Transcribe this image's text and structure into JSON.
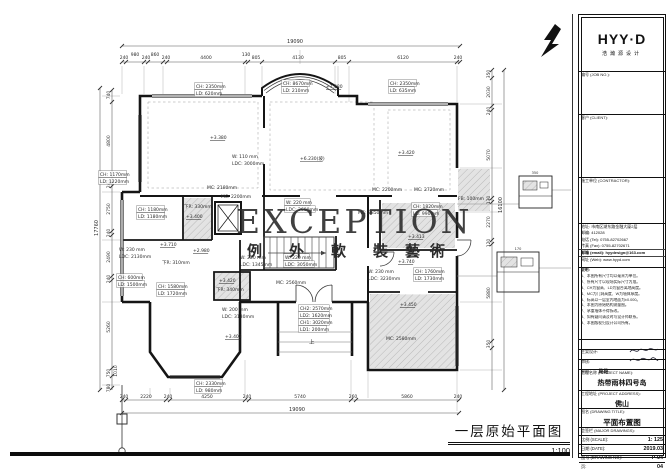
{
  "watermark": {
    "en": "EXCEPTION",
    "cn": [
      "例",
      "外",
      "軟",
      "裝",
      "藝",
      "術"
    ]
  },
  "footer": {
    "title": "一层原始平面图",
    "scale": "1:100"
  },
  "title_block": {
    "logo": "HYY·D",
    "logo_sub": "浩瀚源设计",
    "job_label": "编号 (JOB NO.):",
    "client_label": "客户 (CLIENT):",
    "contractor_label": "施工单位 (CONTRACTOR):",
    "contact": [
      "地址: 市南区湖东路金融大厦2层",
      "邮编: 412028",
      "电话 (Tel): 0755-82702667",
      "传真 (Fax): 0755-82702671",
      "邮箱 (email): hyydesign@163.com",
      "网址 (Web): www.hyyd.com"
    ],
    "notes_title": "说明:",
    "notes": [
      "1、本图所有尺寸均以毫米为单位。",
      "2、所有尺寸以现场实际尺寸为准。",
      "3、CH为窗高、LD为窗台离地高度。",
      "4、MC为门洞高度、W为墙体厚度。",
      "5、标高以一层室内地面为±0.000。",
      "6、本图为原始结构测量图。",
      "7、承重墙体不得拆改。",
      "8、如有疑问请及时与设计师联系。",
      "9、本图版权归设计公司所有。"
    ],
    "sign1_label": "主案设计:",
    "sign2_label": "审核:",
    "sign3_label": "制图:",
    "sign3_value": "路路",
    "project_name_label": "工程名称 (PROJECT NAME):",
    "project_name": "热带雨林四号岛",
    "project_addr_label": "工程地址 (PROJECT ADDRESS):",
    "project_addr": "佛山",
    "drawing_title_label": "图名 (DRAWING TITLE):",
    "drawing_title": "平面布置图",
    "countersign_label": "会签栏 (MAJOR DRAWINGS):",
    "scale_label": "比例 (SCALE):",
    "scale": "1: 125",
    "date_label": "日期 (DATE):",
    "date": "2019.03",
    "no_label": "图号 (DRAWING NO):",
    "no": "P-04",
    "page_label": "页:",
    "page": "04"
  },
  "plan_labels": [
    {
      "t": "19090",
      "x": 295,
      "y": 43,
      "s": 5,
      "a": "m"
    },
    {
      "t": "240",
      "x": 124,
      "y": 59,
      "a": "m"
    },
    {
      "t": "980",
      "x": 135,
      "y": 56,
      "a": "m"
    },
    {
      "t": "240",
      "x": 146,
      "y": 59,
      "a": "m"
    },
    {
      "t": "860",
      "x": 155,
      "y": 56,
      "a": "m"
    },
    {
      "t": "240",
      "x": 166,
      "y": 59,
      "a": "m"
    },
    {
      "t": "4400",
      "x": 206,
      "y": 59,
      "a": "m"
    },
    {
      "t": "130",
      "x": 246,
      "y": 56,
      "a": "m"
    },
    {
      "t": "805",
      "x": 256,
      "y": 59,
      "a": "m"
    },
    {
      "t": "4130",
      "x": 298,
      "y": 59,
      "a": "m"
    },
    {
      "t": "805",
      "x": 342,
      "y": 59,
      "a": "m"
    },
    {
      "t": "6120",
      "x": 403,
      "y": 59,
      "a": "m"
    },
    {
      "t": "240",
      "x": 458,
      "y": 59,
      "a": "m"
    },
    {
      "t": "240",
      "x": 124,
      "y": 398,
      "a": "m"
    },
    {
      "t": "2220",
      "x": 146,
      "y": 398,
      "a": "m"
    },
    {
      "t": "240",
      "x": 168,
      "y": 398,
      "a": "m"
    },
    {
      "t": "4250",
      "x": 207,
      "y": 398,
      "a": "m"
    },
    {
      "t": "240",
      "x": 247,
      "y": 398,
      "a": "m"
    },
    {
      "t": "5740",
      "x": 300,
      "y": 398,
      "a": "m"
    },
    {
      "t": "260",
      "x": 353,
      "y": 398,
      "a": "m"
    },
    {
      "t": "5860",
      "x": 407,
      "y": 398,
      "a": "m"
    },
    {
      "t": "240",
      "x": 458,
      "y": 398,
      "a": "m"
    },
    {
      "t": "19090",
      "x": 297,
      "y": 411,
      "s": 5,
      "a": "m"
    },
    {
      "t": "740",
      "x": 110,
      "y": 95,
      "r": -90,
      "a": "m"
    },
    {
      "t": "4800",
      "x": 110,
      "y": 141,
      "r": -90,
      "a": "m"
    },
    {
      "t": "240",
      "x": 110,
      "y": 184,
      "r": -90,
      "a": "m"
    },
    {
      "t": "2750",
      "x": 110,
      "y": 209,
      "r": -90,
      "a": "m"
    },
    {
      "t": "240",
      "x": 110,
      "y": 233,
      "r": -90,
      "a": "m"
    },
    {
      "t": "2490",
      "x": 110,
      "y": 257,
      "r": -90,
      "a": "m"
    },
    {
      "t": "240",
      "x": 110,
      "y": 279,
      "r": -90,
      "a": "m"
    },
    {
      "t": "5260",
      "x": 110,
      "y": 327,
      "r": -90,
      "a": "m"
    },
    {
      "t": "750",
      "x": 110,
      "y": 373,
      "r": -90,
      "a": "m"
    },
    {
      "t": "1010",
      "x": 117,
      "y": 371,
      "r": -90,
      "a": "m"
    },
    {
      "t": "780",
      "x": 110,
      "y": 388,
      "r": -90,
      "a": "m"
    },
    {
      "t": "17760",
      "x": 98,
      "y": 228,
      "r": -90,
      "s": 5,
      "a": "m"
    },
    {
      "t": "350",
      "x": 490,
      "y": 74,
      "r": -90,
      "a": "m"
    },
    {
      "t": "2030",
      "x": 490,
      "y": 92,
      "r": -90,
      "a": "m"
    },
    {
      "t": "240",
      "x": 490,
      "y": 111,
      "r": -90,
      "a": "m"
    },
    {
      "t": "5070",
      "x": 490,
      "y": 155,
      "r": -90,
      "a": "m"
    },
    {
      "t": "130",
      "x": 490,
      "y": 200,
      "r": -90,
      "a": "m"
    },
    {
      "t": "2270",
      "x": 490,
      "y": 222,
      "r": -90,
      "a": "m"
    },
    {
      "t": "120",
      "x": 490,
      "y": 243,
      "r": -90,
      "a": "m"
    },
    {
      "t": "5880",
      "x": 490,
      "y": 293,
      "r": -90,
      "a": "m"
    },
    {
      "t": "350",
      "x": 490,
      "y": 344,
      "r": -90,
      "a": "m"
    },
    {
      "t": "16100",
      "x": 502,
      "y": 205,
      "r": -90,
      "s": 5,
      "a": "m"
    },
    {
      "t": "CH: 2350mm",
      "x": 196,
      "y": 88,
      "b": 1
    },
    {
      "t": "LD: 620mm",
      "x": 196,
      "y": 95,
      "b": 1
    },
    {
      "t": "CH: 8670mm",
      "x": 283,
      "y": 85,
      "b": 1
    },
    {
      "t": "LD: 210mm",
      "x": 283,
      "y": 92,
      "b": 1
    },
    {
      "t": "+7.380",
      "x": 326,
      "y": 88,
      "u": 1
    },
    {
      "t": "CH: 2350mm",
      "x": 390,
      "y": 85,
      "b": 1
    },
    {
      "t": "LD: 635mm",
      "x": 390,
      "y": 92,
      "b": 1
    },
    {
      "t": "CH: 1170mm",
      "x": 100,
      "y": 176,
      "b": 1
    },
    {
      "t": "LD: 1220mm",
      "x": 100,
      "y": 183,
      "b": 1
    },
    {
      "t": "+3.380",
      "x": 210,
      "y": 139,
      "u": 1
    },
    {
      "t": "W: 110 mm",
      "x": 232,
      "y": 158
    },
    {
      "t": "LDC: 3000mm",
      "x": 232,
      "y": 165
    },
    {
      "t": "+6.230(坡)",
      "x": 300,
      "y": 160,
      "u": 1
    },
    {
      "t": "+3.420",
      "x": 398,
      "y": 154,
      "u": 1
    },
    {
      "t": "MC: 2180mm",
      "x": 207,
      "y": 189
    },
    {
      "t": "MC: 2200mm",
      "x": 221,
      "y": 198
    },
    {
      "t": "MC: 2200mm",
      "x": 372,
      "y": 191
    },
    {
      "t": "MC: 2720mm",
      "x": 414,
      "y": 191
    },
    {
      "t": "FB: 100mm",
      "x": 458,
      "y": 200
    },
    {
      "t": "CH: 1180mm",
      "x": 138,
      "y": 211,
      "b": 1
    },
    {
      "t": "LD: 1180mm",
      "x": 138,
      "y": 218,
      "b": 1
    },
    {
      "t": "下R: 330mm",
      "x": 184,
      "y": 208
    },
    {
      "t": "+3.400",
      "x": 186,
      "y": 218,
      "u": 1
    },
    {
      "t": "+3.710",
      "x": 160,
      "y": 246,
      "u": 1
    },
    {
      "t": "下R: 310mm",
      "x": 162,
      "y": 264
    },
    {
      "t": "+2.980",
      "x": 193,
      "y": 252,
      "u": 1
    },
    {
      "t": "W: 230 mm",
      "x": 119,
      "y": 251
    },
    {
      "t": "LDC: 2130mm",
      "x": 119,
      "y": 258
    },
    {
      "t": "CH: 600mm",
      "x": 118,
      "y": 279,
      "b": 1
    },
    {
      "t": "LD: 1500mm",
      "x": 118,
      "y": 286,
      "b": 1
    },
    {
      "t": "CH: 1580mm",
      "x": 158,
      "y": 288,
      "b": 1
    },
    {
      "t": "LD: 1720mm",
      "x": 158,
      "y": 295,
      "b": 1
    },
    {
      "t": "+3.420",
      "x": 219,
      "y": 282,
      "u": 1
    },
    {
      "t": "下R: 340mm",
      "x": 216,
      "y": 291
    },
    {
      "t": "W: 200 mm",
      "x": 222,
      "y": 311
    },
    {
      "t": "LDC: 3130mm",
      "x": 222,
      "y": 318
    },
    {
      "t": "+3.403",
      "x": 225,
      "y": 338,
      "u": 1
    },
    {
      "t": "CH: 2330mm",
      "x": 196,
      "y": 385,
      "b": 1
    },
    {
      "t": "LD: 980mm",
      "x": 196,
      "y": 392,
      "b": 1
    },
    {
      "t": "W: 220 mm",
      "x": 286,
      "y": 204,
      "b": 1
    },
    {
      "t": "LDC: 2600mm",
      "x": 286,
      "y": 211,
      "b": 1
    },
    {
      "t": "MC: 2850mm",
      "x": 358,
      "y": 214
    },
    {
      "t": "W: 220 mm",
      "x": 240,
      "y": 259
    },
    {
      "t": "LDC: 1345mm",
      "x": 240,
      "y": 266
    },
    {
      "t": "W: 220 mm",
      "x": 285,
      "y": 259,
      "b": 1
    },
    {
      "t": "LDC: 3050mm",
      "x": 285,
      "y": 266,
      "b": 1
    },
    {
      "t": "CH: 1820mm",
      "x": 413,
      "y": 208,
      "b": 1
    },
    {
      "t": "LD: 990mm",
      "x": 413,
      "y": 215,
      "b": 1
    },
    {
      "t": "+3.413",
      "x": 408,
      "y": 238,
      "u": 1
    },
    {
      "t": "+3.740",
      "x": 398,
      "y": 263,
      "u": 1
    },
    {
      "t": "W: 230 mm",
      "x": 368,
      "y": 273
    },
    {
      "t": "LDC: 3230mm",
      "x": 368,
      "y": 280
    },
    {
      "t": "CH: 1760mm",
      "x": 415,
      "y": 273,
      "b": 1
    },
    {
      "t": "LD: 1730mm",
      "x": 415,
      "y": 280,
      "b": 1
    },
    {
      "t": "+3.450",
      "x": 400,
      "y": 306,
      "u": 1
    },
    {
      "t": "MC: 2580mm",
      "x": 386,
      "y": 340
    },
    {
      "t": "MC: 2560mm",
      "x": 276,
      "y": 284
    },
    {
      "t": "CH2: 2570mm",
      "x": 300,
      "y": 310,
      "b": 1
    },
    {
      "t": "LD2: 1620mm",
      "x": 300,
      "y": 317,
      "b": 1
    },
    {
      "t": "CH1: 3020mm",
      "x": 300,
      "y": 324,
      "b": 1
    },
    {
      "t": "LD1: 200mm",
      "x": 300,
      "y": 331,
      "b": 1
    },
    {
      "t": "上",
      "x": 309,
      "y": 344,
      "s": 5.5
    },
    {
      "t": "350",
      "x": 535,
      "y": 174,
      "s": 3.5,
      "a": "m"
    },
    {
      "t": "170",
      "x": 518,
      "y": 250,
      "s": 3.5,
      "a": "m"
    }
  ]
}
